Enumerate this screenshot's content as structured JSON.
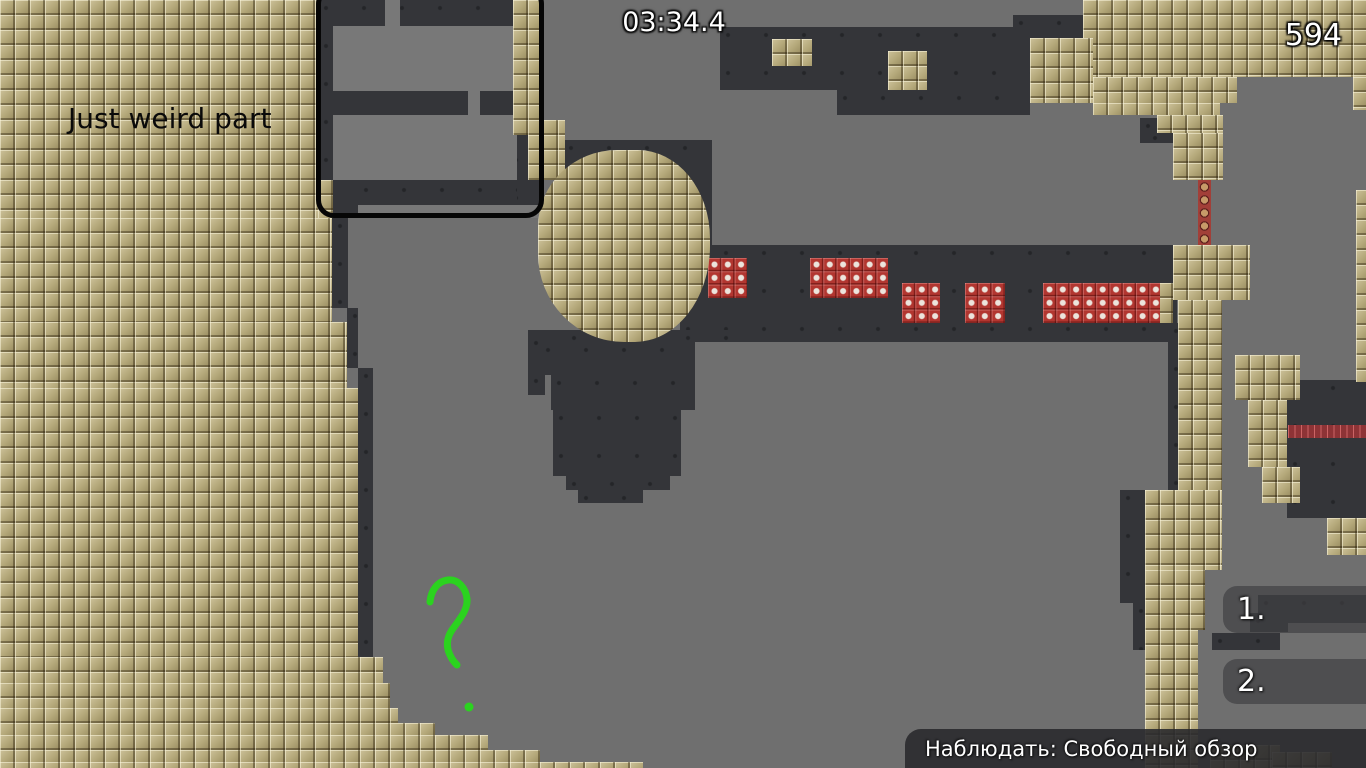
{
  "hud": {
    "timer": "03:34.4",
    "score": "594",
    "spectate_label": "Наблюдать: Свободный обзор",
    "rank_labels": [
      "1.",
      "2."
    ]
  },
  "annotations": {
    "note": "Just weird part"
  },
  "colors": {
    "background_gray": "#6f6f6f",
    "room_gray": "#787878",
    "cave_dark": "#343539",
    "tile_tan": "#b2a578",
    "brick_red": "#b23630",
    "marker_green": "#2bd31f",
    "outline_black": "#060606",
    "hud_text": "#ffffff"
  },
  "map": {
    "outline_box": [
      316,
      -14,
      228,
      232
    ],
    "blob": [
      538,
      150,
      172,
      192
    ],
    "regions": [
      {
        "cls": "dark",
        "name": "cave-dark-region",
        "rects": [
          [
            318,
            0,
            224,
            218
          ],
          [
            720,
            27,
            310,
            63
          ],
          [
            837,
            90,
            193,
            25
          ],
          [
            1013,
            15,
            70,
            23
          ],
          [
            680,
            245,
            497,
            97
          ],
          [
            563,
            140,
            149,
            105
          ],
          [
            528,
            330,
            230,
            12
          ],
          [
            528,
            335,
            17,
            60
          ],
          [
            540,
            342,
            155,
            33
          ],
          [
            551,
            375,
            144,
            35
          ],
          [
            553,
            410,
            128,
            66
          ],
          [
            566,
            476,
            104,
            14
          ],
          [
            578,
            490,
            65,
            13
          ],
          [
            332,
            218,
            16,
            90
          ],
          [
            347,
            308,
            11,
            60
          ],
          [
            358,
            368,
            15,
            289
          ],
          [
            1140,
            118,
            30,
            25
          ],
          [
            1147,
            130,
            30,
            13
          ],
          [
            1287,
            380,
            79,
            138
          ],
          [
            1168,
            323,
            10,
            167
          ],
          [
            1120,
            490,
            25,
            113
          ],
          [
            1133,
            603,
            22,
            47
          ],
          [
            1258,
            595,
            108,
            28
          ],
          [
            1250,
            613,
            38,
            19
          ],
          [
            1212,
            633,
            68,
            17
          ]
        ]
      },
      {
        "cls": "room",
        "name": "gray-room-region",
        "rects": [
          [
            333,
            26,
            180,
            65
          ],
          [
            385,
            0,
            15,
            26
          ],
          [
            468,
            91,
            12,
            24
          ],
          [
            333,
            115,
            184,
            65
          ],
          [
            358,
            205,
            185,
            13
          ]
        ]
      },
      {
        "cls": "dark",
        "name": "cave-dark-region",
        "rects": [
          [
            358,
            182,
            159,
            23
          ]
        ]
      },
      {
        "cls": "tan",
        "name": "tile-wall-region",
        "rects": [
          [
            0,
            0,
            318,
            218
          ],
          [
            0,
            218,
            332,
            104
          ],
          [
            0,
            322,
            347,
            66
          ],
          [
            0,
            388,
            358,
            269
          ],
          [
            0,
            657,
            383,
            26
          ],
          [
            0,
            683,
            390,
            25
          ],
          [
            0,
            708,
            398,
            15
          ],
          [
            0,
            723,
            435,
            12
          ],
          [
            0,
            735,
            488,
            15
          ],
          [
            0,
            750,
            540,
            12
          ],
          [
            0,
            762,
            643,
            6
          ],
          [
            513,
            0,
            29,
            135
          ],
          [
            528,
            120,
            37,
            60
          ],
          [
            318,
            180,
            15,
            38
          ],
          [
            772,
            39,
            40,
            27
          ],
          [
            888,
            51,
            39,
            39
          ],
          [
            1083,
            0,
            283,
            77
          ],
          [
            1030,
            38,
            63,
            65
          ],
          [
            1093,
            77,
            144,
            26
          ],
          [
            1093,
            103,
            127,
            12
          ],
          [
            1157,
            115,
            66,
            18
          ],
          [
            1173,
            133,
            50,
            47
          ],
          [
            1353,
            77,
            13,
            33
          ],
          [
            1356,
            190,
            10,
            192
          ],
          [
            1173,
            245,
            77,
            55
          ],
          [
            1158,
            283,
            15,
            40
          ],
          [
            1178,
            300,
            44,
            270
          ],
          [
            1145,
            490,
            77,
            80
          ],
          [
            1145,
            570,
            60,
            60
          ],
          [
            1145,
            630,
            53,
            138
          ],
          [
            1235,
            355,
            65,
            45
          ],
          [
            1248,
            400,
            39,
            67
          ],
          [
            1262,
            467,
            38,
            36
          ],
          [
            1327,
            518,
            39,
            37
          ],
          [
            1210,
            745,
            70,
            23
          ],
          [
            1272,
            752,
            60,
            16
          ]
        ]
      },
      {
        "cls": "red",
        "name": "brick-block",
        "rects": [
          [
            708,
            258,
            39,
            40
          ],
          [
            810,
            258,
            78,
            40
          ],
          [
            902,
            283,
            38,
            40
          ],
          [
            965,
            283,
            40,
            40
          ],
          [
            1043,
            283,
            117,
            40
          ]
        ]
      },
      {
        "cls": "skull",
        "name": "hazard-strip-vertical",
        "rects": [
          [
            1198,
            180,
            13,
            65
          ]
        ]
      },
      {
        "cls": "spike",
        "name": "hazard-strip-horizontal",
        "rects": [
          [
            1288,
            425,
            78,
            13
          ]
        ]
      }
    ]
  }
}
